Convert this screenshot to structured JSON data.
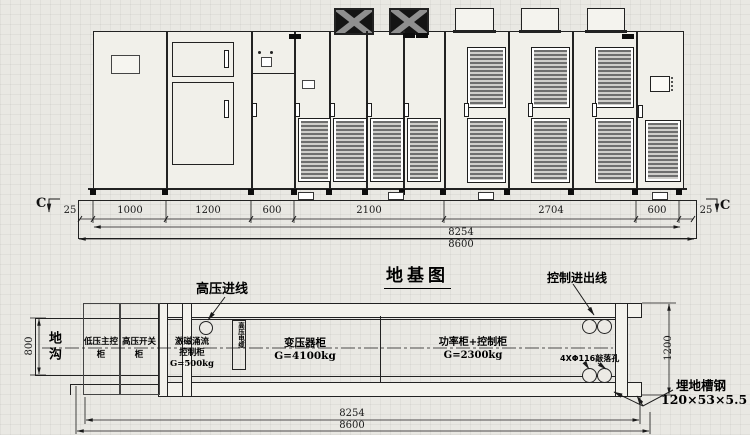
{
  "title": "地基图",
  "section_marker": "C",
  "elevation_dims": {
    "segments": [
      "25",
      "1000",
      "1200",
      "600",
      "2100",
      "2704",
      "600",
      "25"
    ],
    "total_inner": "8254",
    "total_outer": "8600"
  },
  "plan": {
    "hv_incoming_label": "高压进线",
    "control_io_label": "控制进出线",
    "trench_label": "地沟",
    "trench_width": "800",
    "depth_dim": "1200",
    "lv_main_cabinet": {
      "line1": "低压主控",
      "line2": "柜"
    },
    "hv_switch_cabinet": {
      "line1": "高压开关",
      "line2": "柜"
    },
    "excitation_cabinet": {
      "line1": "激磁涌流",
      "line2": "控制柜",
      "line3": "G=500kg"
    },
    "hv_cable_label": "高压电缆",
    "transformer_cabinet": {
      "name": "变压器柜",
      "weight": "G=4100kg"
    },
    "power_cabinet": {
      "name": "功率柜+控制柜",
      "weight": "G=2300kg"
    },
    "knockout_label": "4XΦ116敲落孔",
    "channel_steel_label": "埋地槽钢",
    "channel_steel_spec": "120×53×5.5",
    "total_inner": "8254",
    "total_outer": "8600"
  }
}
